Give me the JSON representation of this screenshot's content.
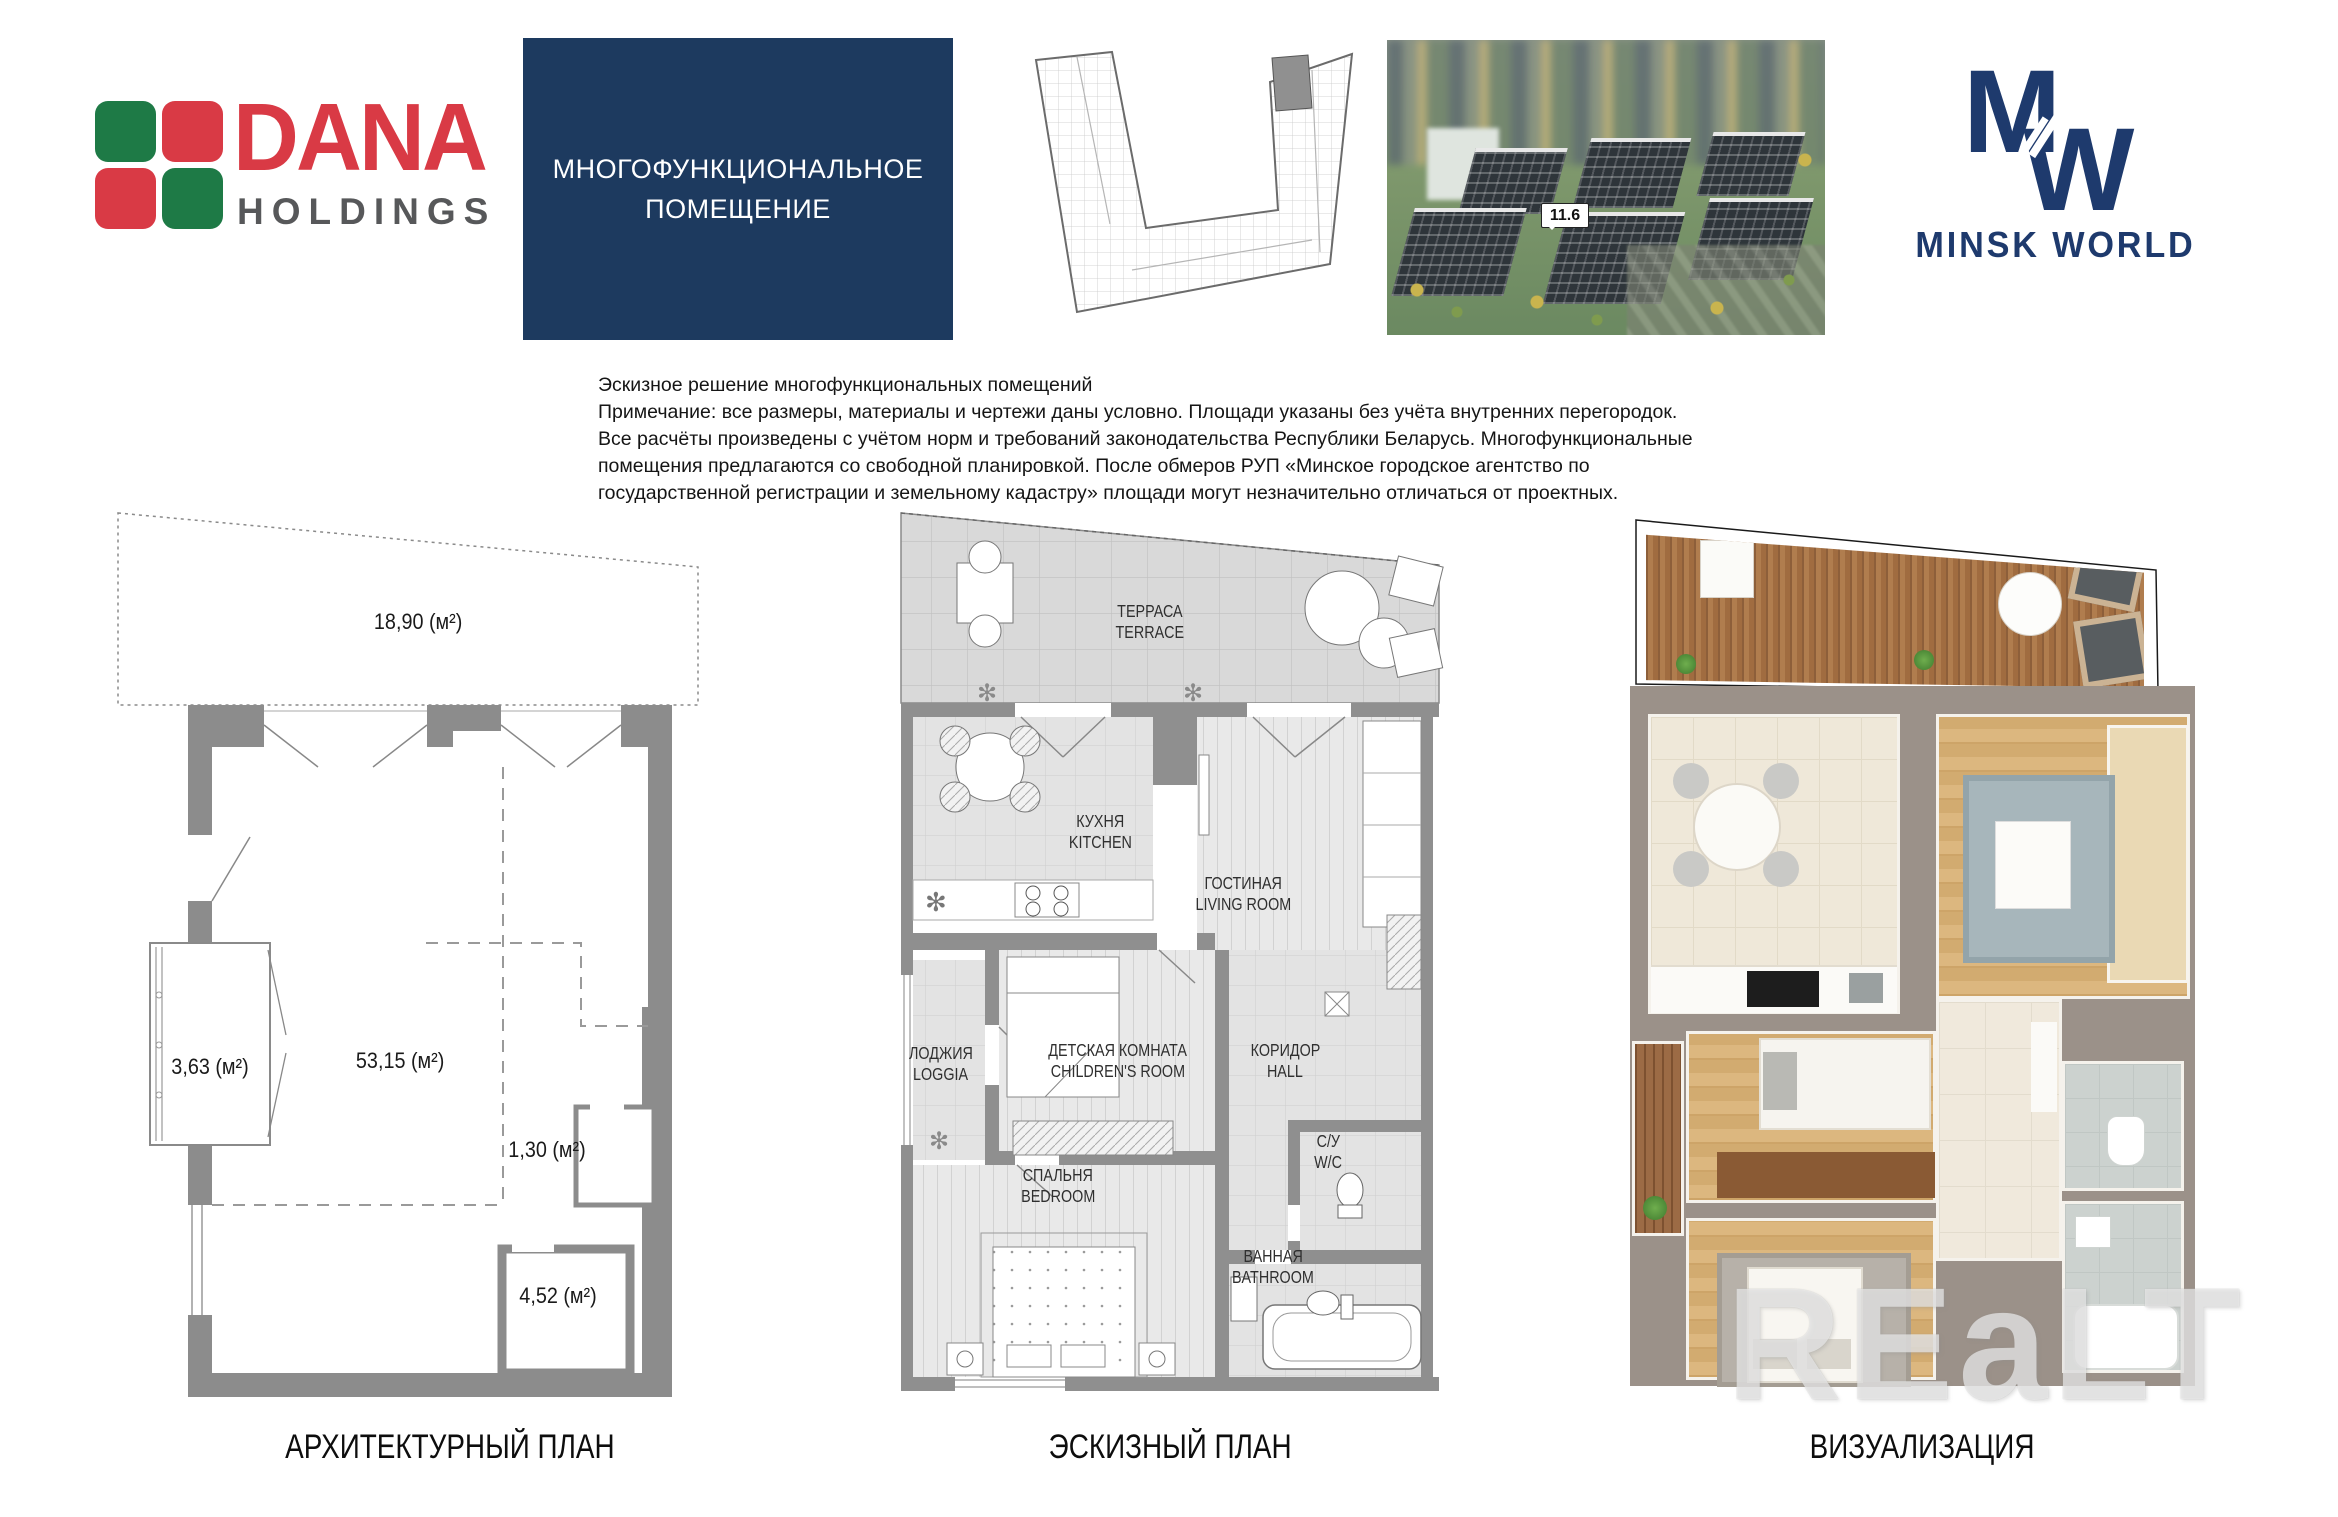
{
  "header": {
    "dana": {
      "brand": "DANA",
      "word": "HOLDINGS"
    },
    "title_box": {
      "line1": "МНОГОФУНКЦИОНАЛЬНОЕ",
      "line2": "ПОМЕЩЕНИЕ"
    },
    "aerial": {
      "label": "11.6"
    },
    "minsk": {
      "monogram_m": "M",
      "monogram_w": "W",
      "name": "MINSK WORLD"
    }
  },
  "disclaimer": {
    "lines": [
      "Эскизное решение многофункциональных помещений",
      "Примечание: все размеры, материалы и чертежи даны условно. Площади указаны без учёта внутренних перегородок.",
      "Все расчёты произведены с учётом норм и требований законодательства Республики Беларусь. Многофункциональные",
      "помещения предлагаются со свободной планировкой. После обмеров РУП «Минское городское агентство по",
      "государственной регистрации и земельному кадастру» площади могут незначительно отличаться от проектных."
    ]
  },
  "plans": {
    "architectural": {
      "caption": "АРХИТЕКТУРНЫЙ ПЛАН",
      "areas": {
        "terrace": "18,90 (м²)",
        "loggia": "3,63 (м²)",
        "main": "53,15 (м²)",
        "duct": "1,30 (м²)",
        "bath": "4,52 (м²)"
      }
    },
    "sketch": {
      "caption": "ЭСКИЗНЫЙ ПЛАН",
      "rooms": {
        "terrace": {
          "ru": "ТЕРРАСА",
          "en": "TERRACE"
        },
        "kitchen": {
          "ru": "КУХНЯ",
          "en": "KITCHEN"
        },
        "living": {
          "ru": "ГОСТИНАЯ",
          "en": "LIVING ROOM"
        },
        "loggia": {
          "ru": "ЛОДЖИЯ",
          "en": "LOGGIA"
        },
        "children": {
          "ru": "ДЕТСКАЯ КОМНАТА",
          "en": "CHILDREN'S ROOM"
        },
        "hall": {
          "ru": "КОРИДОР",
          "en": "HALL"
        },
        "bedroom": {
          "ru": "СПАЛЬНЯ",
          "en": "BEDROOM"
        },
        "wc": {
          "ru": "С/У",
          "en": "W/C"
        },
        "bathroom": {
          "ru": "ВАННАЯ",
          "en": "BATHROOM"
        }
      }
    },
    "visualization": {
      "caption": "ВИЗУАЛИЗАЦИЯ"
    }
  },
  "watermark": {
    "text": "REaLT"
  },
  "icons": {
    "flower": "✻"
  },
  "colors": {
    "navy_box": "#1d3a5f",
    "logo_navy": "#1e3a6d",
    "dana_red": "#d93a45",
    "dana_green": "#1e7a46",
    "holdings_gray": "#57585a",
    "wall_gray": "#8c8c8c"
  }
}
